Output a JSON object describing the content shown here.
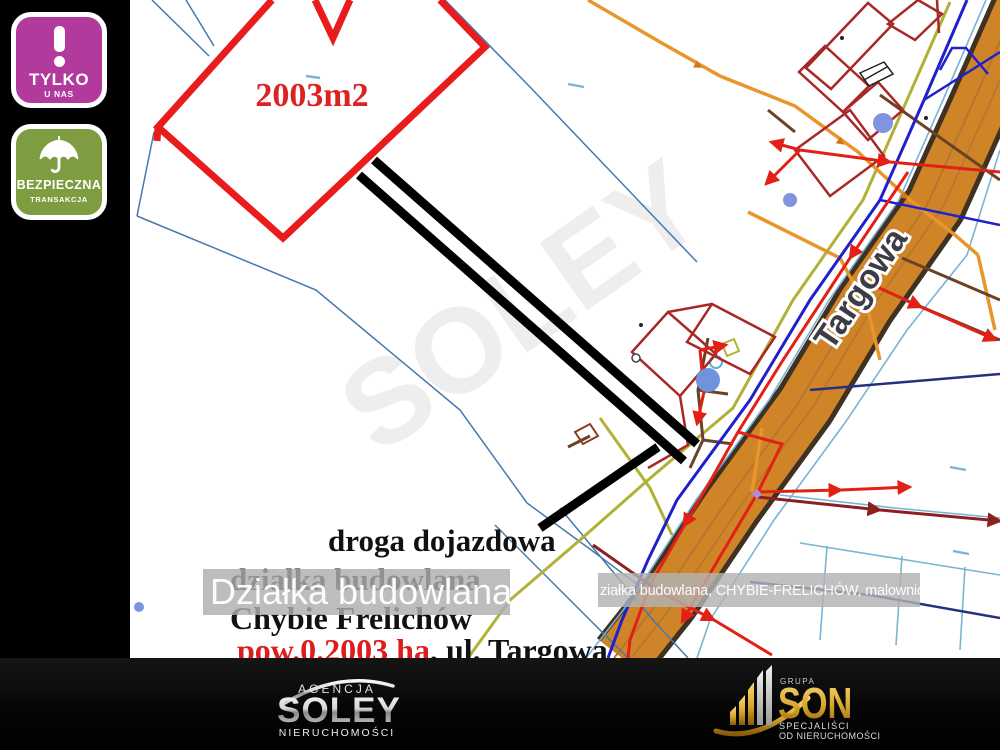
{
  "badges": {
    "exclusive": {
      "icon": "exclamation-icon",
      "title": "TYLKO",
      "subtitle": "U NAS",
      "bg_color": "#b23a9c"
    },
    "secure": {
      "icon": "umbrella-icon",
      "title": "BEZPIECZNA",
      "subtitle": "TRANSAKCJA",
      "bg_color": "#7e9c40"
    }
  },
  "map": {
    "plot": {
      "area_label": "2003m2",
      "outline_color": "#e81c1c"
    },
    "street": {
      "name": "Targowa",
      "surface_color": "#cf8428"
    },
    "annotations": {
      "access_road": "droga dojazdowa",
      "listing_type": "działka budowlana",
      "location": "Chybie Frelichów",
      "area": "pow.0.2003 ha",
      "address": ", ul. Targowa",
      "area_color": "#dd1c1c"
    },
    "watermarks": {
      "large": "Działka budowlana",
      "small": "ziałka budowlana, CHYBIE-FRELICHÓW, malownicze okolic",
      "faint": "SOLEY"
    }
  },
  "footer": {
    "soley": {
      "line_top": "AGENCJA",
      "name": "SOLEY",
      "line_bottom": "NIERUCHOMOŚCI"
    },
    "son": {
      "line_top": "GRUPA",
      "name": "SON",
      "line_bottom_1": "SPECJALIŚCI",
      "line_bottom_2": "OD NIERUCHOMOŚCI",
      "accent_color": "#d9a62e"
    }
  }
}
